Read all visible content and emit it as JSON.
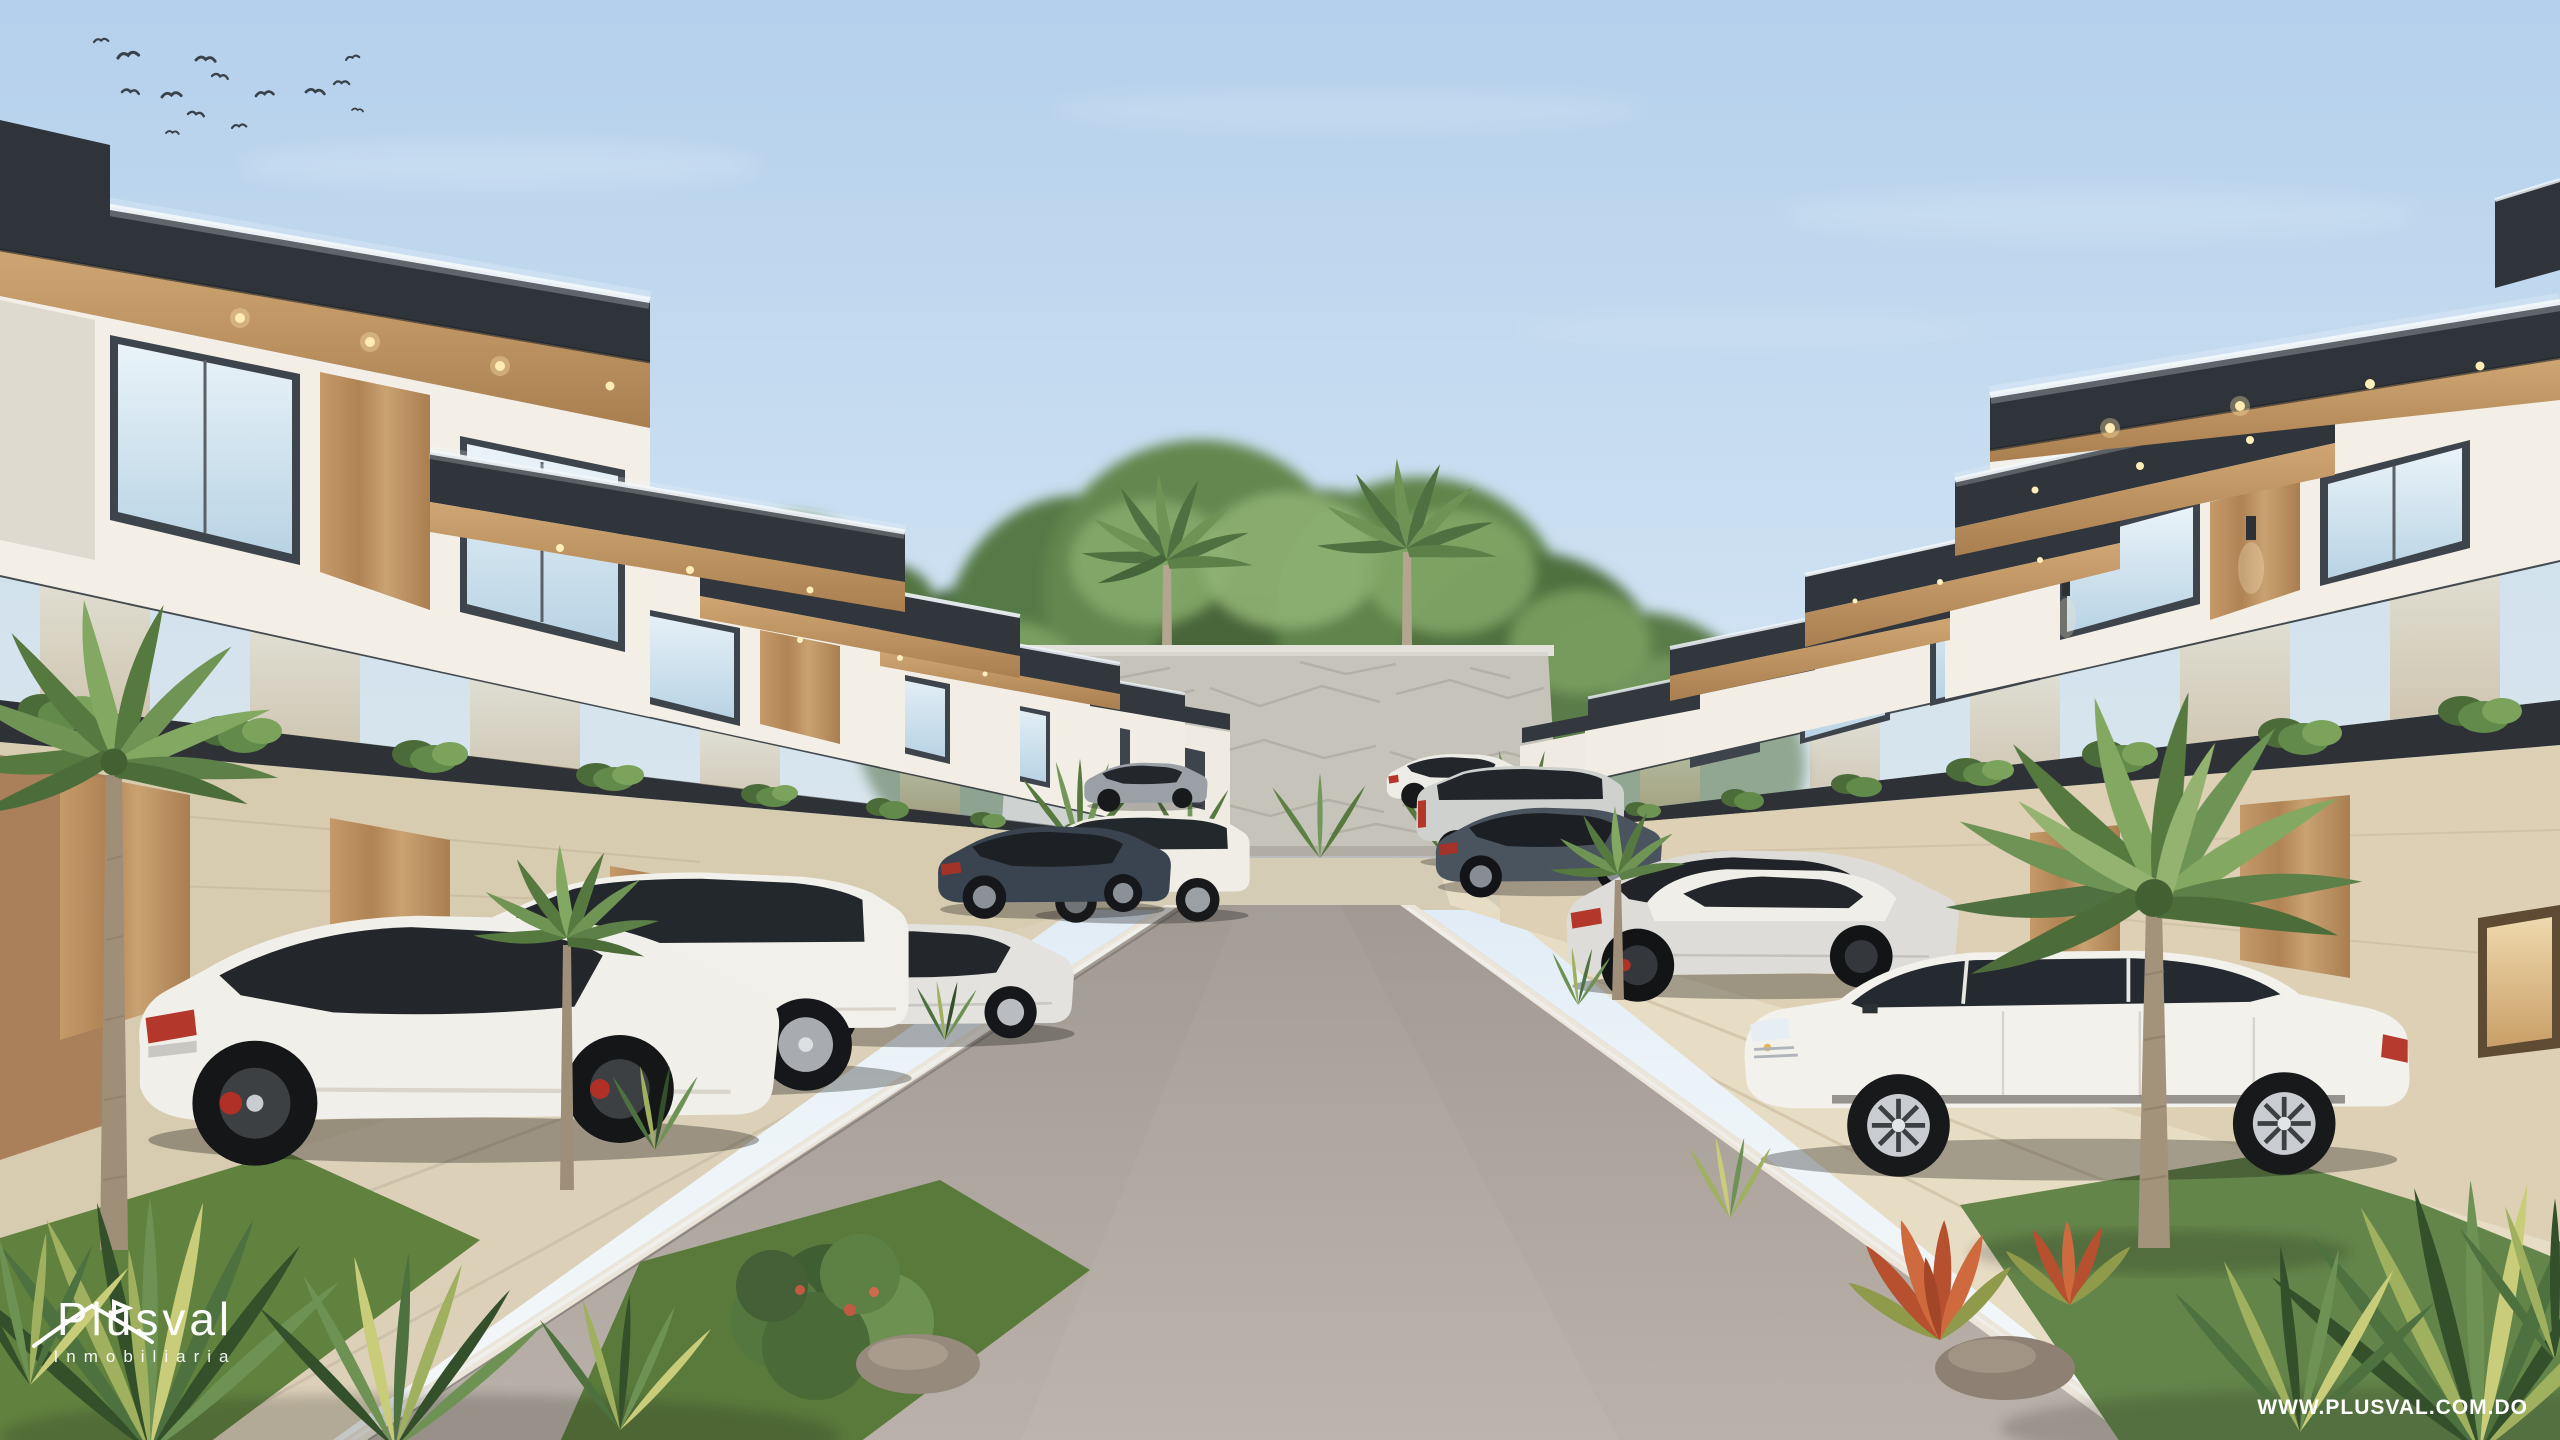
{
  "branding": {
    "logo_title": "Plusval",
    "logo_subtitle": "Inmobiliaria",
    "website_label": "WWW.PLUSVAL.COM.DO"
  },
  "scene": {
    "type": "3d-architectural-rendering",
    "subject": "Modern two-story townhouse residential community, central street perspective",
    "sky": "clear light blue with faint clouds and a flock of birds top-left",
    "street": "central asphalt road flanked by beige concrete sidewalks and driveways",
    "end_feature": "stone privacy wall with tropical trees and royal palms behind it",
    "left_row_units": 6,
    "right_row_units": 6,
    "vegetation": [
      "palm trees",
      "variegated spiky shrubs",
      "balcony ivy planters",
      "red bromeliads",
      "lawn patches",
      "decorative rocks"
    ],
    "cars_left": [
      "white sportback sedan",
      "white boxy SUV",
      "silver sedan",
      "dark gray sedan",
      "white compact SUV",
      "gray compact sedan"
    ],
    "cars_right": [
      "white luxury SUV",
      "white sedan",
      "silver sportback",
      "dark gray sedan",
      "silver compact SUV",
      "white crossover"
    ]
  },
  "palette": {
    "sky_top": "#b4d0ec",
    "sky_horizon": "#f4f7f8",
    "roof_fascia": "#33383e",
    "wood_accent": "#b98e60",
    "facade_white": "#f3efe7",
    "stone_wall": "#cfccc4",
    "road": "#aaa29b",
    "sidewalk": "#e0d4bd",
    "foliage": "#5d7f45",
    "taillight_red": "#b5372c",
    "text_white": "#ffffff"
  }
}
